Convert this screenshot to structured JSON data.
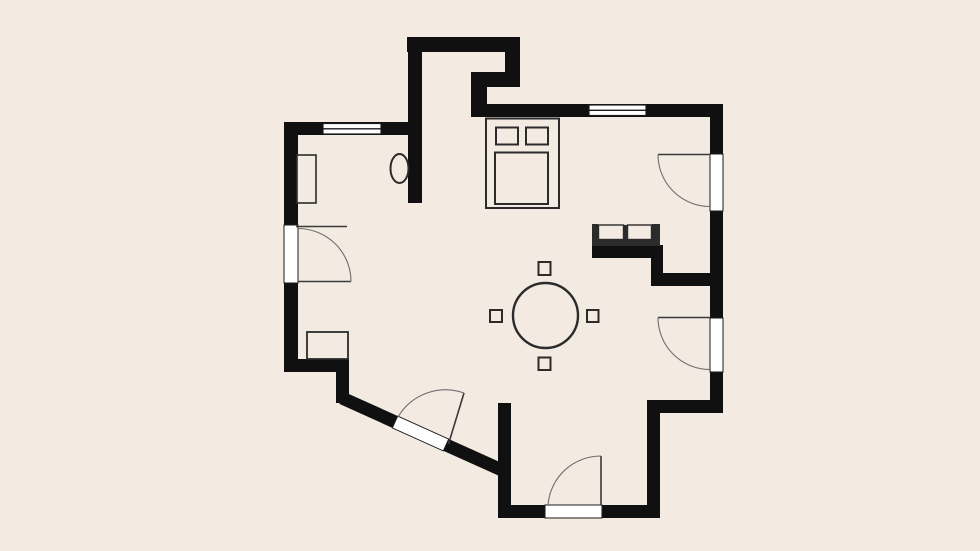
{
  "title": "apartment-floor-plan",
  "colors": {
    "background": "#f3eae2",
    "wall": "#101010",
    "opening-fill": "#ffffff",
    "opening-line": "#1a1a1a",
    "furniture-line": "#2b2b2b",
    "furniture-fill": "#f3eae2",
    "door-arc": "#6e6e6e",
    "door-leaf": "#3a3a3a"
  },
  "plan": {
    "type": "floor-plan",
    "text_labels": [],
    "windows": 2,
    "door_openings": 5,
    "furniture": [
      "double-bed-with-two-pillows",
      "wardrobe",
      "oval-basin",
      "low-cabinet",
      "round-table",
      "four-stools",
      "two-seat-sofa"
    ]
  }
}
